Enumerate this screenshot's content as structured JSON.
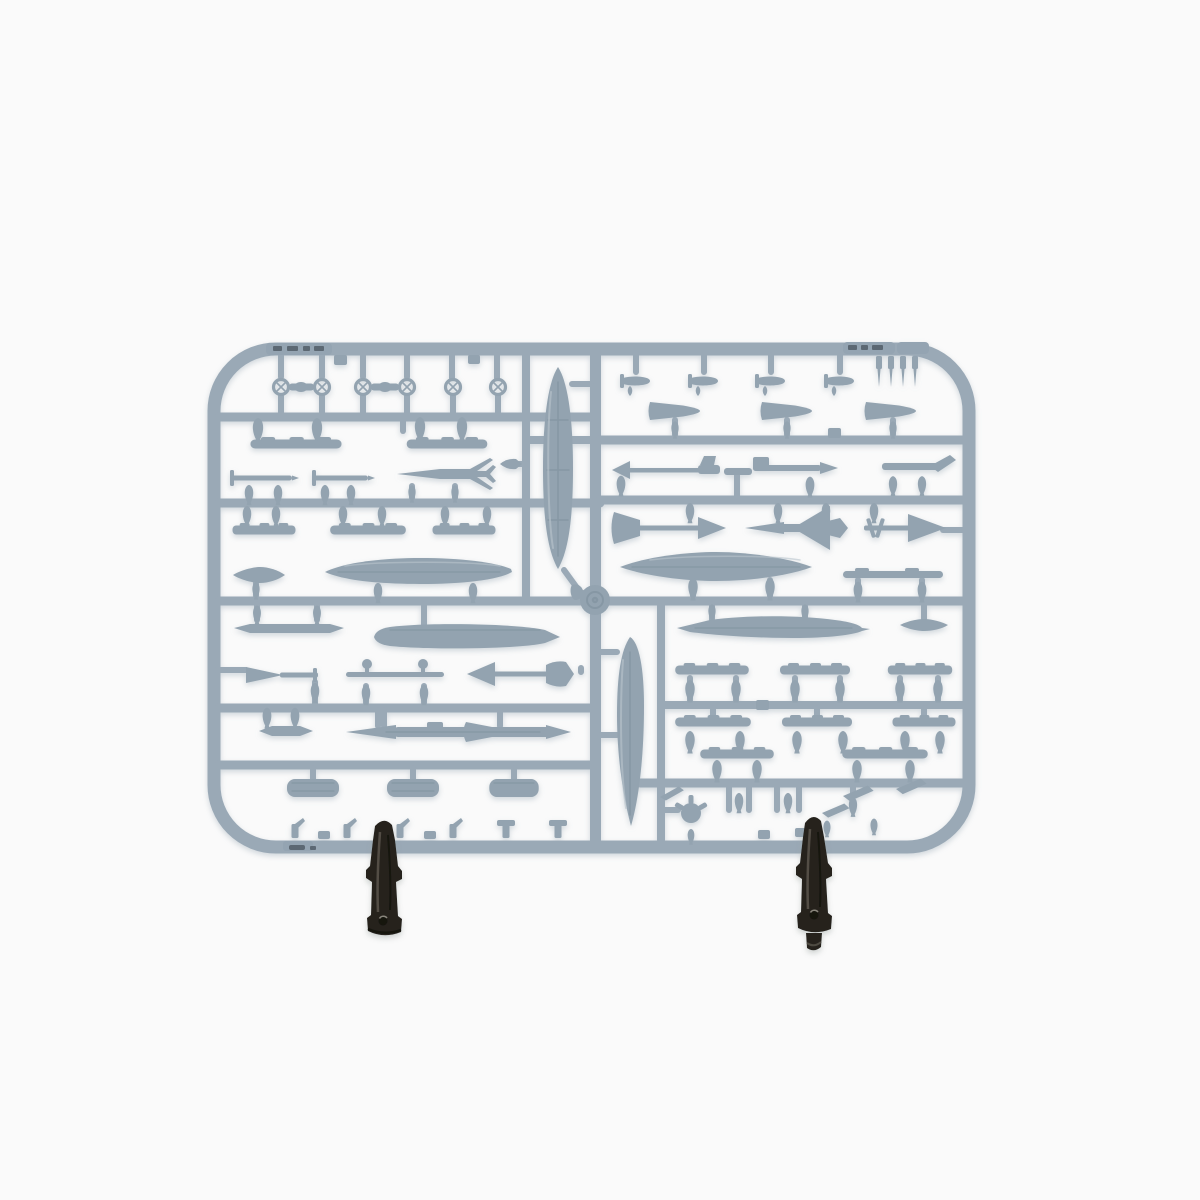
{
  "image": {
    "kind": "product-photo",
    "subject": "grey injection-molded plastic model kit sprue with aircraft ordnance parts, held upright by two black clips at its bottom rail",
    "orientation": "landscape sprue centered on white seamless background"
  },
  "colors": {
    "background": "#fafafa",
    "runner": "#9aa9b6",
    "runner_plate": "#94a4b2",
    "part": "#93a3b0",
    "part_dark": "#75879666",
    "detail": "#7c8e9c",
    "highlight": "#bac5cd",
    "mark": "#49545f",
    "clip": "#26231f",
    "clip_dark": "#141210",
    "clip_light": "#5a554b"
  },
  "content": {
    "sprue": {
      "frame": "rounded-rectangle outer runner with one central vertical runner and horizontal row runners",
      "part_types": [
        "large drop tanks (vertical halves on center runner)",
        "slender fuel tanks (horizontal)",
        "finned bombs on pylons",
        "bomb racks / carrier strips",
        "air-to-air missiles with arrowhead and delta fins",
        "winged missile / small aircraft-shaped round",
        "nose cones",
        "ring sights",
        "pitot probes / needle parts",
        "cylindrical pods",
        "small fins and winglets",
        "propeller hub part"
      ],
      "molded_marks": "dark embossed number tags on top rail (left and right) and bottom-left rail"
    },
    "clips": {
      "count": 2,
      "description": "black spring clips gripping bottom rail"
    }
  }
}
